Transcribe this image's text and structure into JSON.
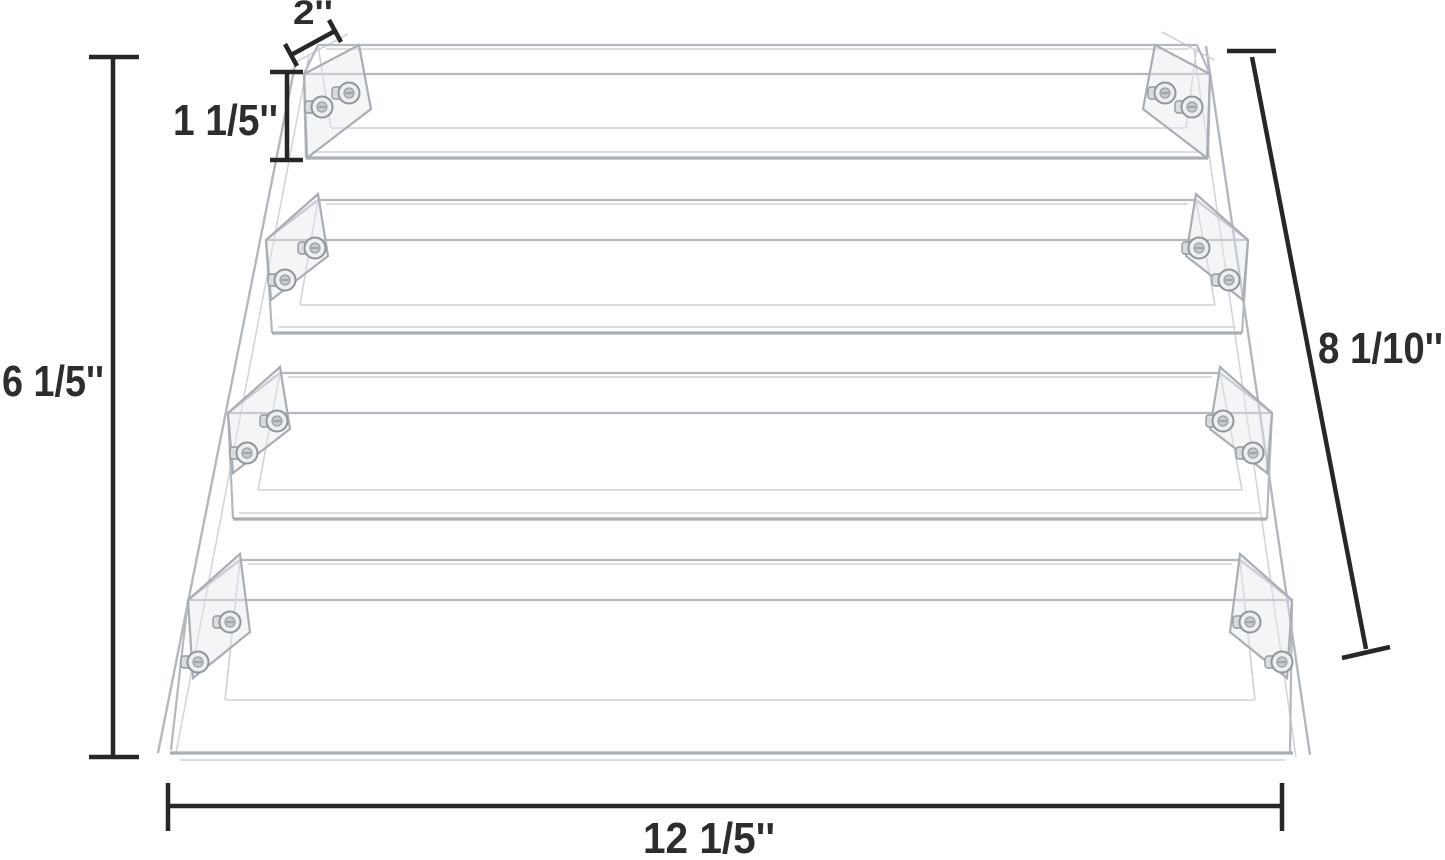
{
  "page": {
    "background": "#ffffff"
  },
  "diagram": {
    "subject": "4-tier clear acrylic display riser",
    "tier_count": 4,
    "colors": {
      "dimension_line": "#272727",
      "label_text": "#2d2d2d",
      "acrylic_edge": "#b4b9bf",
      "acrylic_edge_light": "#cfd3d7",
      "screw_metal": "#c5c9ce"
    },
    "dimensions": {
      "top_depth": {
        "label": "2''"
      },
      "tier_height": {
        "label": "1 1/5''"
      },
      "total_height": {
        "label": "6 1/5''"
      },
      "slant_side": {
        "label": "8 1/10''"
      },
      "total_width": {
        "label": "12 1/5''"
      }
    }
  }
}
